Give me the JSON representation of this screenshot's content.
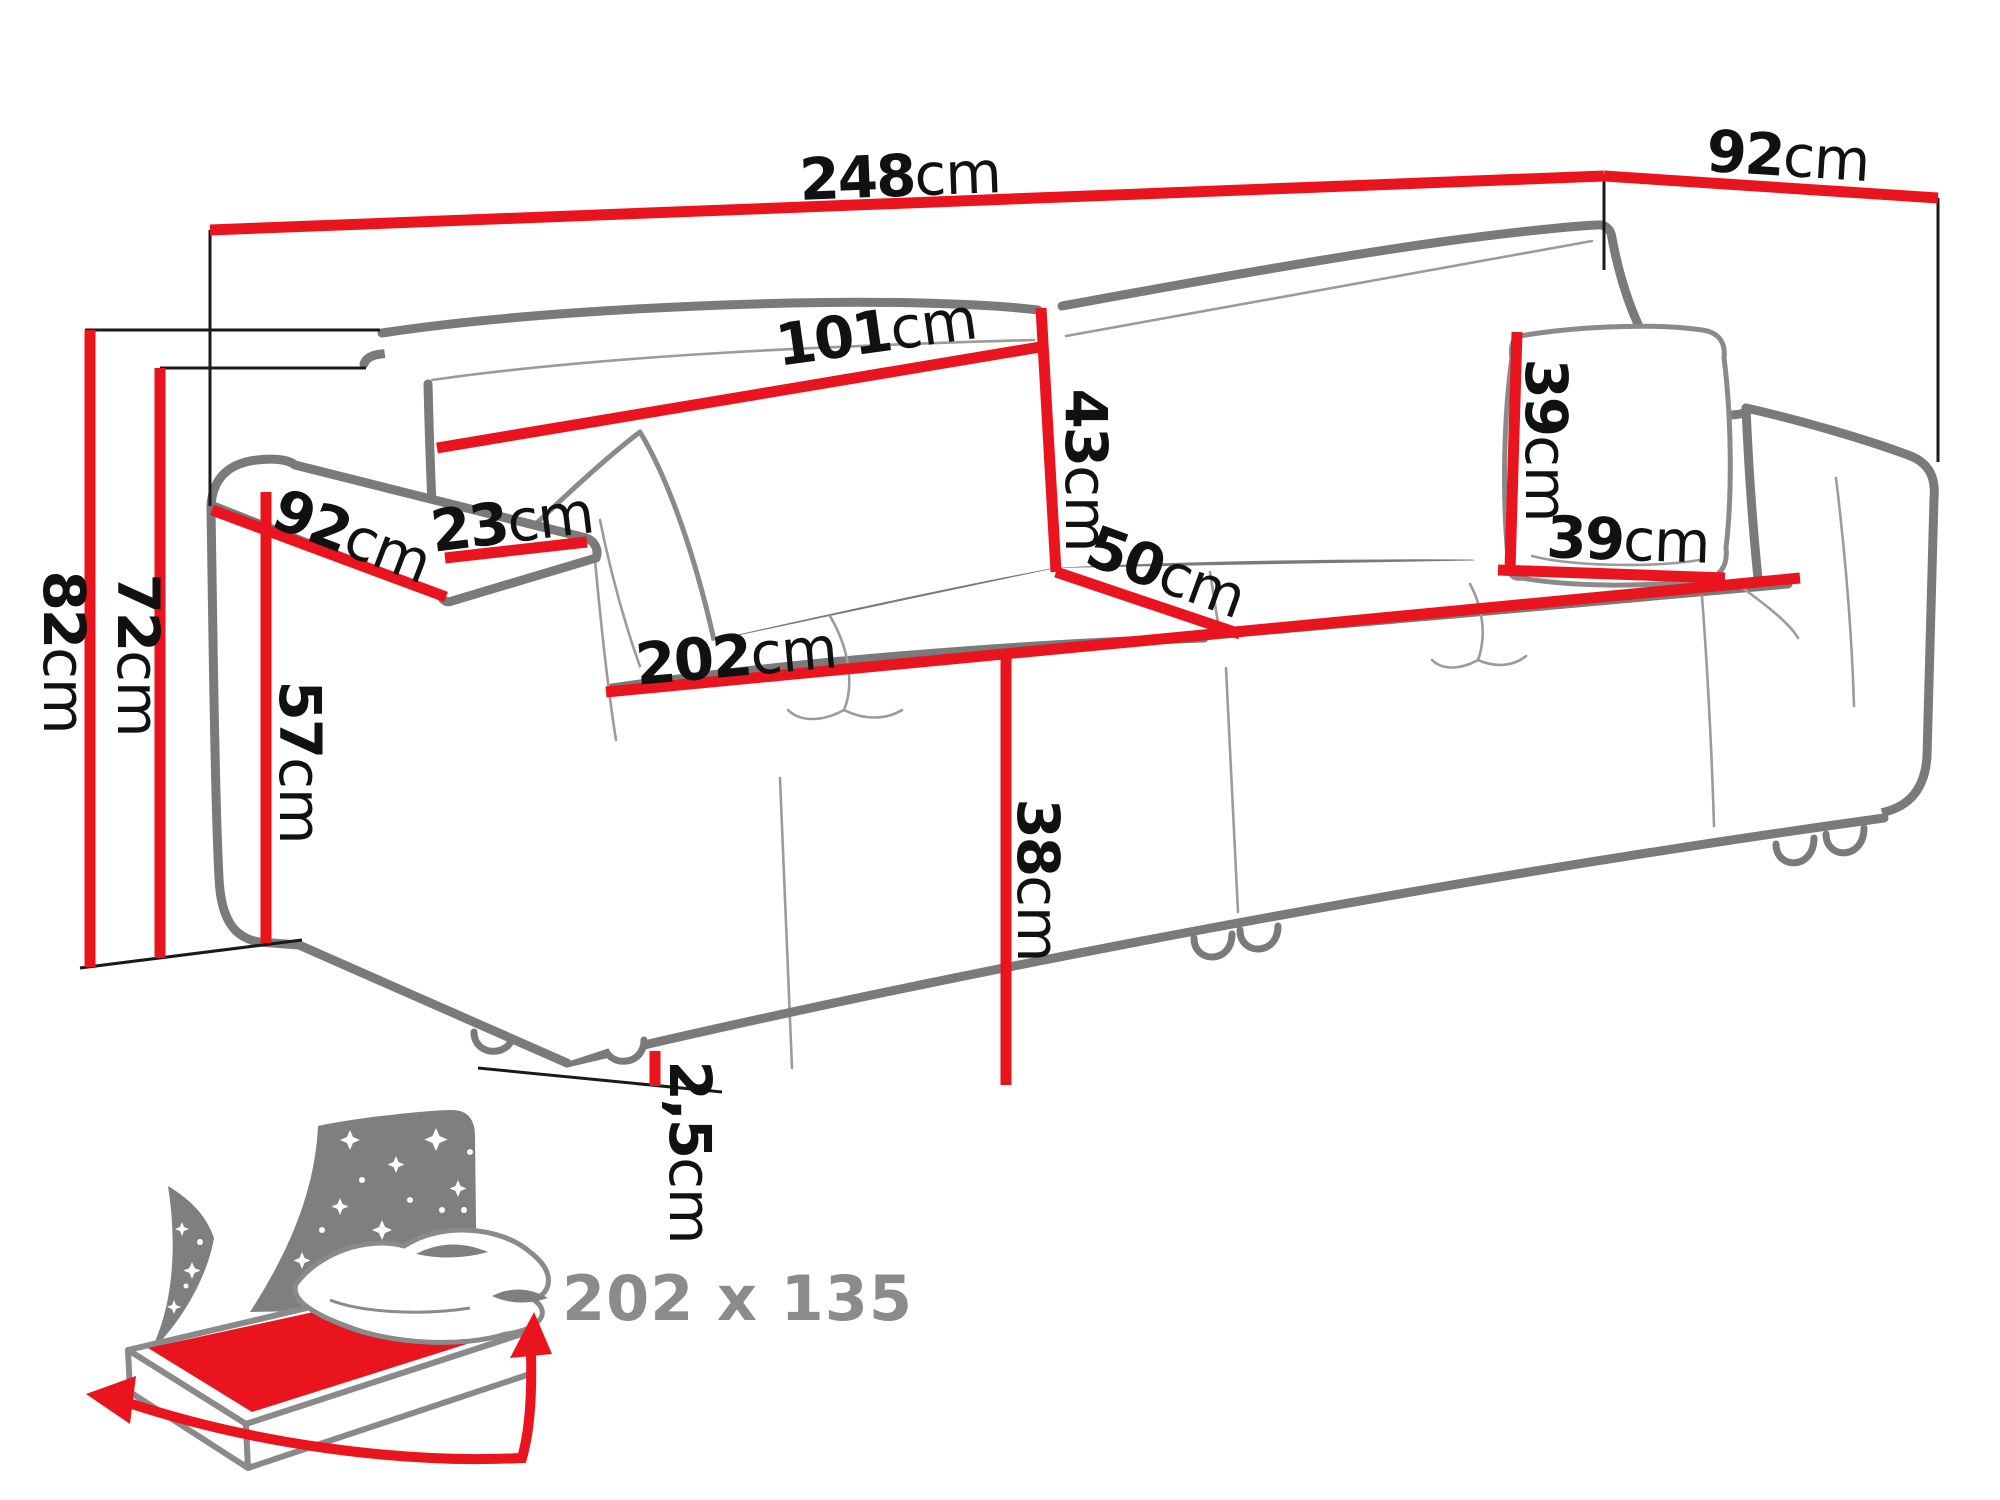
{
  "diagram": {
    "title_type": "sofa-dimension-diagram",
    "units": "cm",
    "colors": {
      "dimension_line_red": "#e9141d",
      "sofa_outline_grey": "#7a7a7a",
      "label_black": "#111111",
      "icon_grey": "#7f7f7f",
      "icon_text_grey": "#8b8b8b"
    },
    "dims": {
      "overall_width": {
        "value": "248",
        "unit": "cm"
      },
      "total_depth": {
        "value": "92",
        "unit": "cm"
      },
      "back_cushion_width": {
        "value": "101",
        "unit": "cm"
      },
      "back_cushion_height": {
        "value": "43",
        "unit": "cm"
      },
      "pillow_height": {
        "value": "39",
        "unit": "cm"
      },
      "pillow_width": {
        "value": "39",
        "unit": "cm"
      },
      "armrest_depth": {
        "value": "92",
        "unit": "cm"
      },
      "armrest_width": {
        "value": "23",
        "unit": "cm"
      },
      "armrest_height": {
        "value": "57",
        "unit": "cm"
      },
      "back_height": {
        "value": "72",
        "unit": "cm"
      },
      "total_height": {
        "value": "82",
        "unit": "cm"
      },
      "seat_width": {
        "value": "202",
        "unit": "cm"
      },
      "seat_depth": {
        "value": "50",
        "unit": "cm"
      },
      "seat_height": {
        "value": "38",
        "unit": "cm"
      },
      "leg_clearance": {
        "value": "2,5",
        "unit": "cm"
      }
    },
    "sleeping_area": {
      "label": "202 x 135"
    }
  }
}
